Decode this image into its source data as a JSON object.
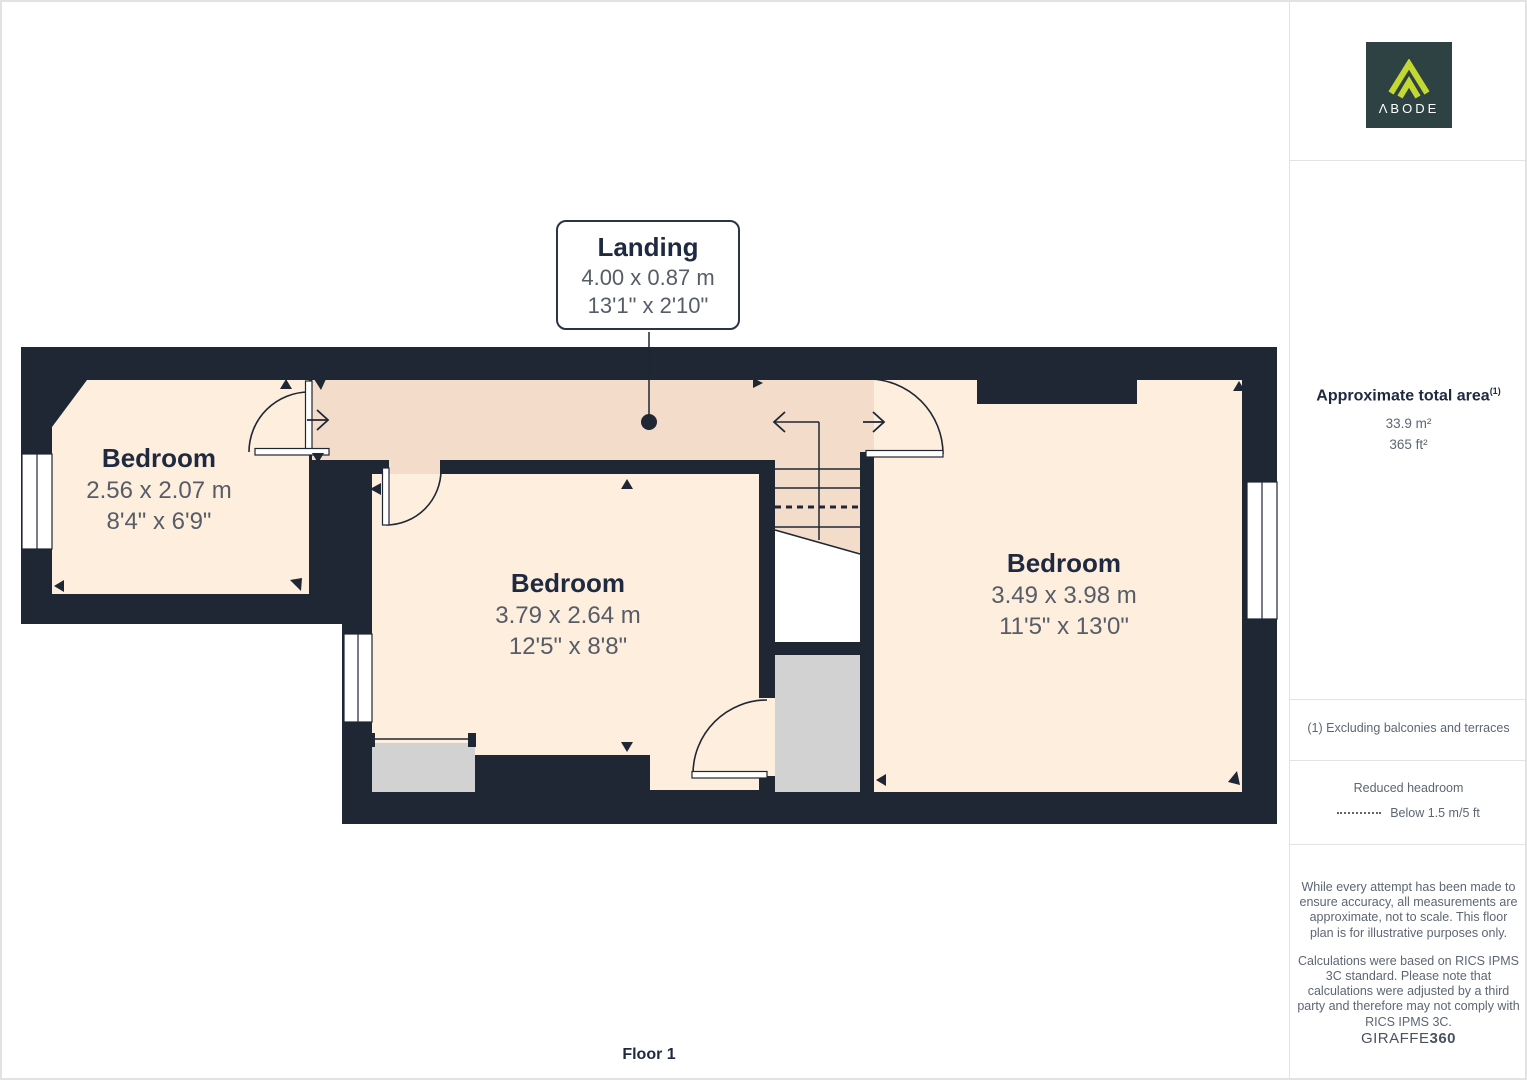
{
  "plan": {
    "floor_label": "Floor 1",
    "rooms": [
      {
        "name": "Bedroom",
        "metric": "2.56 x 2.07 m",
        "imperial": "8'4\" x 6'9\""
      },
      {
        "name": "Bedroom",
        "metric": "3.79 x 2.64 m",
        "imperial": "12'5\" x 8'8\""
      },
      {
        "name": "Bedroom",
        "metric": "3.49 x 3.98 m",
        "imperial": "11'5\" x 13'0\""
      },
      {
        "name": "Landing",
        "metric": "4.00 x 0.87 m",
        "imperial": "13'1\" x 2'10\""
      }
    ],
    "colors": {
      "wall": "#1f2634",
      "room_fill": "#fdeedd",
      "landing_fill": "#f3ddca",
      "storage_fill": "#d2d2d3",
      "label_title": "#1f2940",
      "label_dims": "#565d68"
    }
  },
  "sidebar": {
    "logo_text": "ΛBODE",
    "logo_colors": {
      "background": "#2e4243",
      "accent": "#c3d831"
    },
    "area": {
      "heading": "Approximate total area",
      "note_ref": "(1)",
      "metric": "33.9 m²",
      "imperial": "365 ft²"
    },
    "footnote": "(1) Excluding balconies and terraces",
    "reduced_headroom": {
      "title": "Reduced headroom",
      "legend": "Below 1.5 m/5 ft"
    },
    "disclaimer1": "While every attempt has been made to ensure accuracy, all measurements are approximate, not to scale. This floor plan is for illustrative purposes only.",
    "disclaimer2": "Calculations were based on RICS IPMS 3C standard. Please note that calculations were adjusted by a third party and therefore may not comply with RICS IPMS 3C.",
    "brand": {
      "name": "GIRAFFE",
      "suffix": "360"
    }
  }
}
